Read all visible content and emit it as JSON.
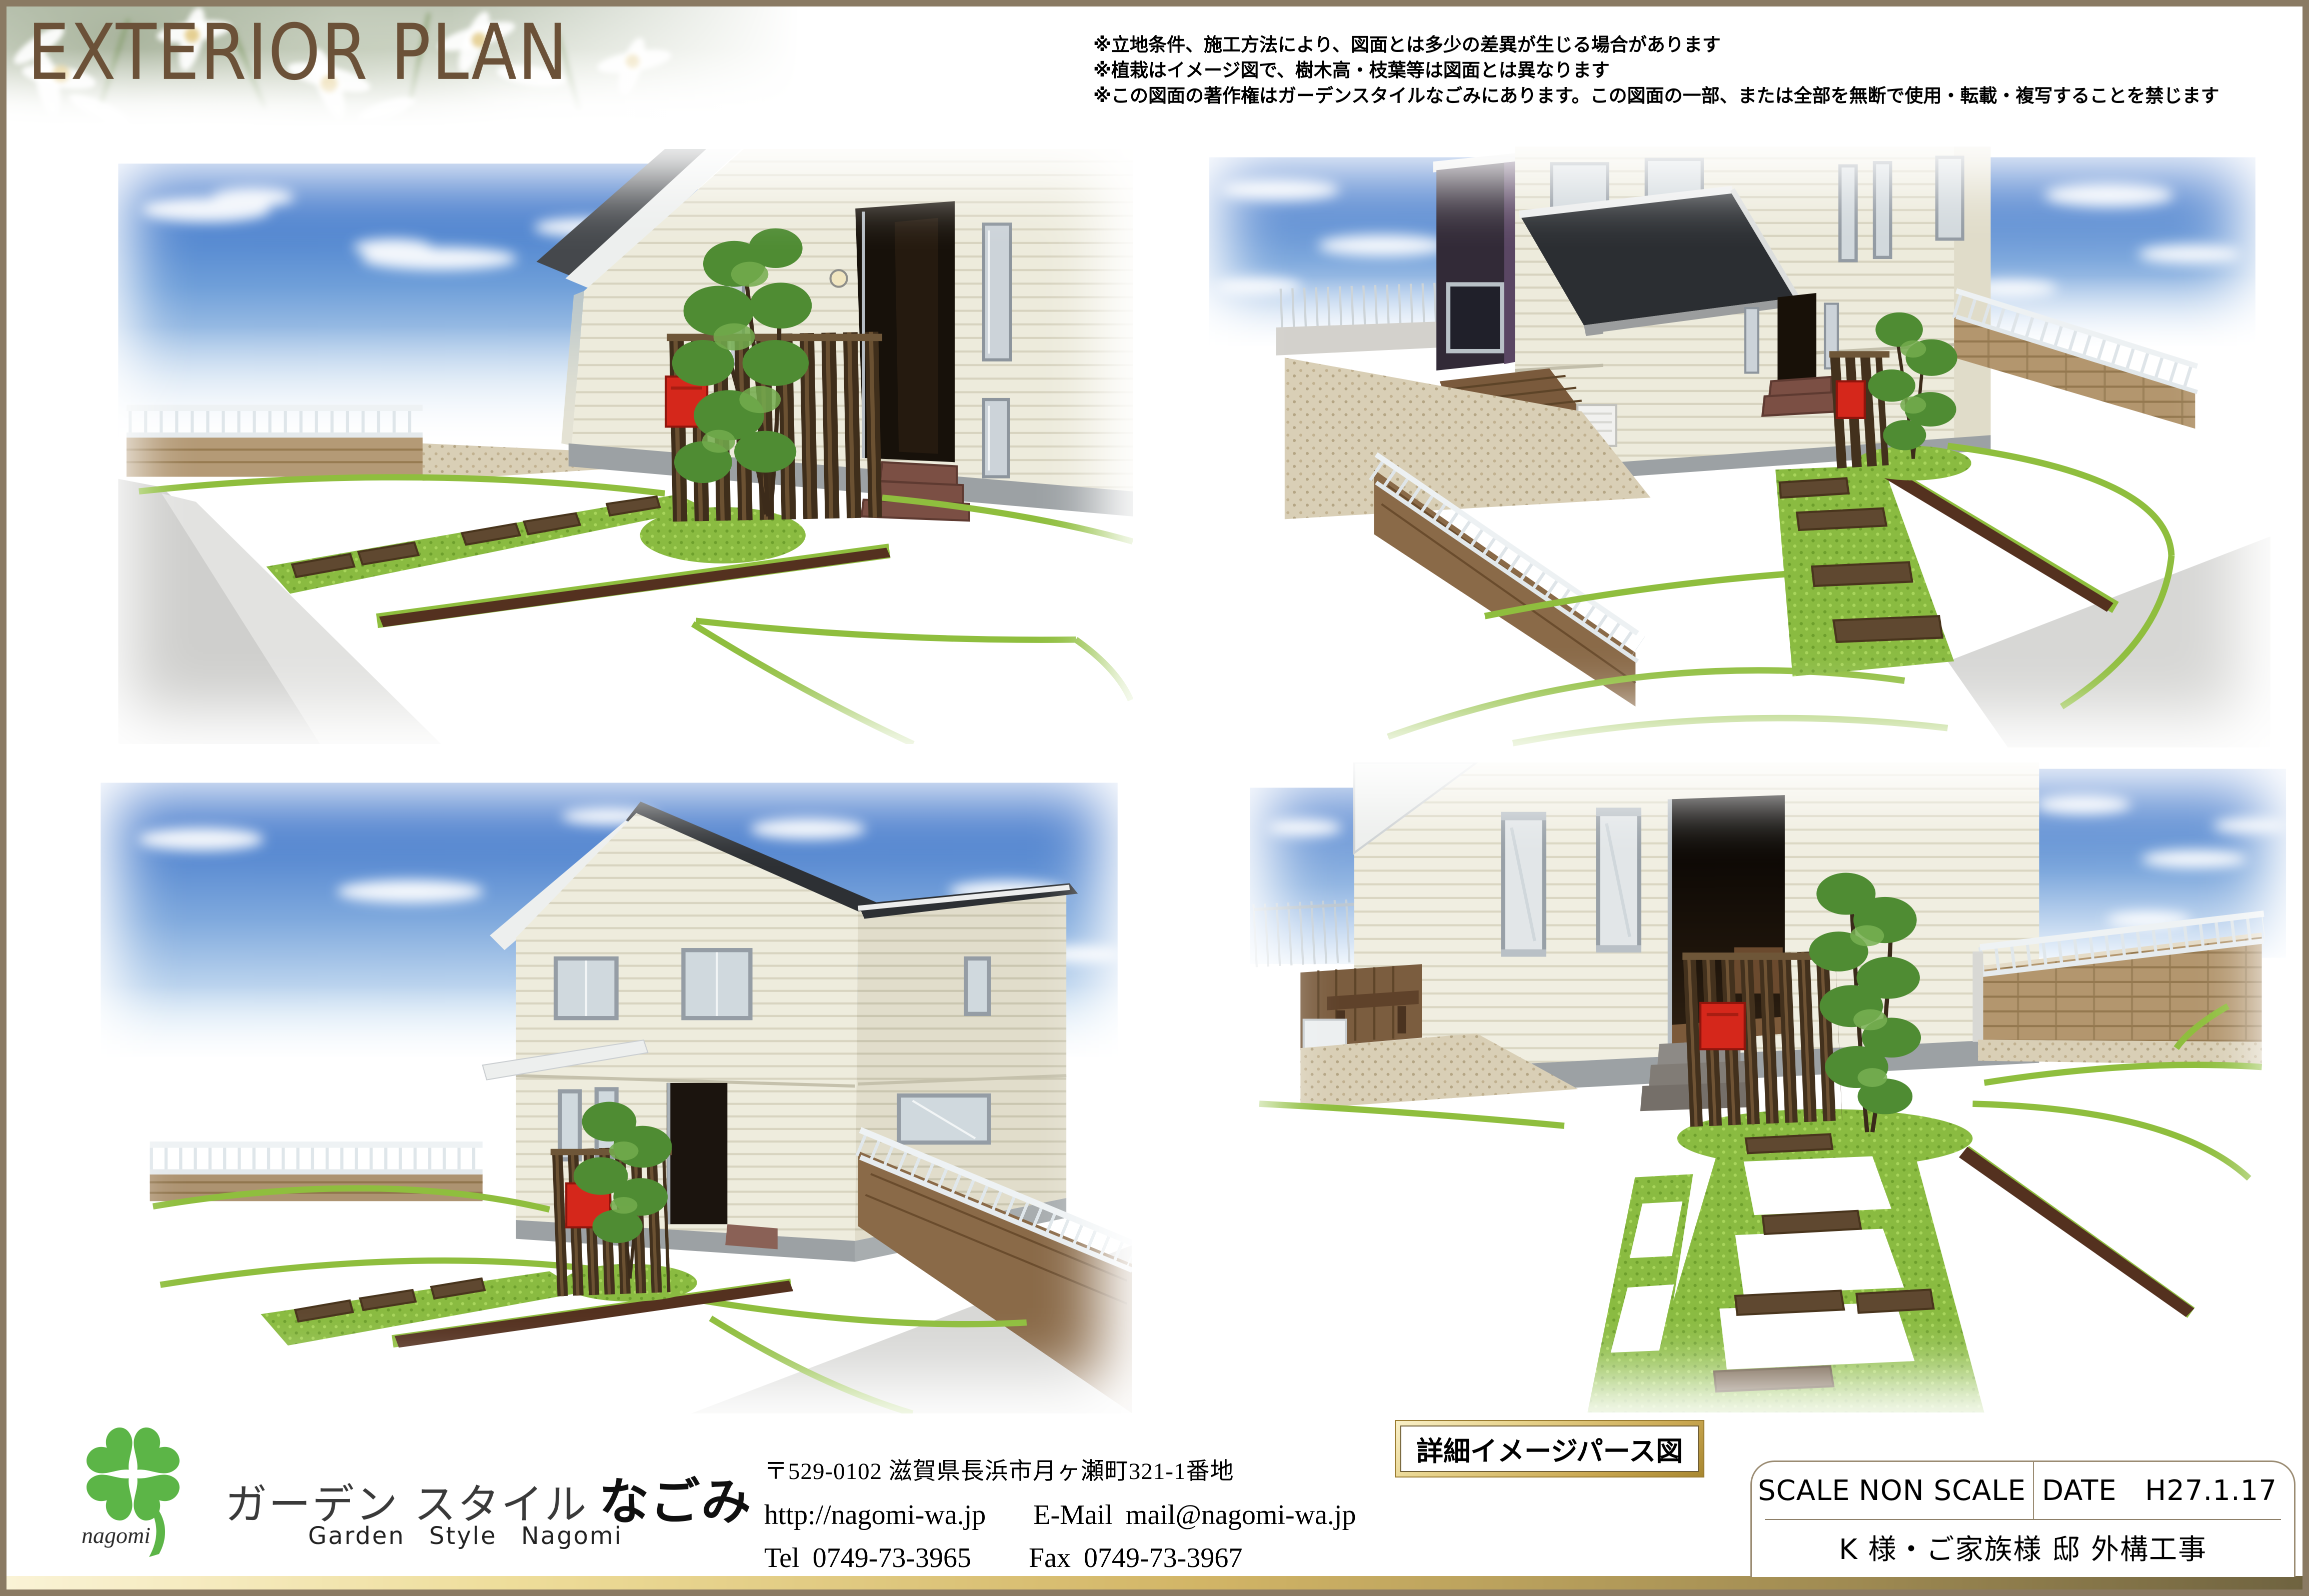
{
  "title": "EXTERIOR PLAN",
  "notes": [
    "※立地条件、施工方法により、図面とは多少の差異が生じる場合があります",
    "※植栽はイメージ図で、樹木高・枝葉等は図面とは異なります",
    "※この図面の著作権はガーデンスタイルなごみにあります。この図面の一部、または全部を無断で使用・転載・複写することを禁じます"
  ],
  "company": {
    "logo_text": "nagomi",
    "name_jp": "ガーデン スタイル",
    "name_jp_accent": "なごみ",
    "name_en": "Garden Style Nagomi",
    "address": "〒529-0102  滋賀県長浜市月ヶ瀬町321-1番地",
    "website": "http://nagomi-wa.jp",
    "email_label": "E-Mail",
    "email": "mail@nagomi-wa.jp",
    "tel_label": "Tel",
    "tel": "0749-73-3965",
    "fax_label": "Fax",
    "fax": "0749-73-3967"
  },
  "stamp": {
    "label": "詳細イメージパース図"
  },
  "title_block": {
    "scale_label": "SCALE",
    "scale_value": "NON SCALE",
    "date_label": "DATE",
    "date_value": "H27.1.17",
    "project": "K 様・ご家族様  邸 外構工事"
  },
  "colors": {
    "frame_brown": "#8a7a63",
    "accent_gold": "#d2b566",
    "title_brown": "#6b5138",
    "mailbox_red": "#d5271b",
    "grass_green": "#8abb41",
    "sky_blue": "#2c66c4",
    "logo_green": "#5cb547"
  }
}
